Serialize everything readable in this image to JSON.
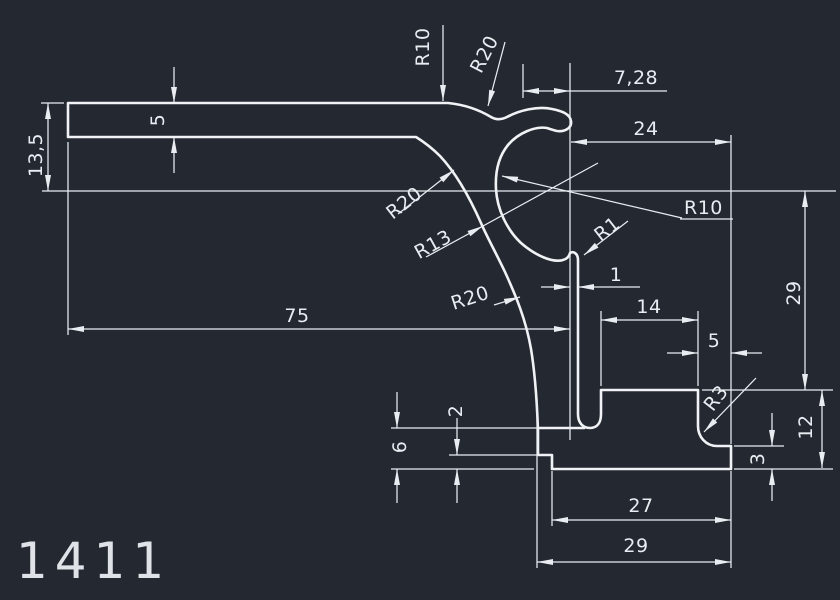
{
  "part_number": "1411",
  "colors": {
    "background": "#232831",
    "line": "#f0f2f5",
    "text": "#e9edf2"
  },
  "dimensions": {
    "overall_height": "13,5",
    "flange_thickness": "5",
    "overall_length": "75",
    "hook_offset": "7,28",
    "top_width": "24",
    "right_height": "29",
    "foot_height": "12",
    "foot_plate_thickness": "3",
    "shelf_width": "14",
    "foot_top_width": "5",
    "slot_gap": "1",
    "step_height": "6",
    "step_plate_thickness": "2",
    "bottom_inner_width": "27",
    "bottom_width": "29"
  },
  "radii": {
    "saddle": "R10",
    "top_curve": "R20",
    "upper_curve": "R20",
    "mid_curve": "R13",
    "lower_curve": "R20",
    "bulb": "R10",
    "leg_fillet": "R1",
    "foot_fillet": "R3"
  }
}
